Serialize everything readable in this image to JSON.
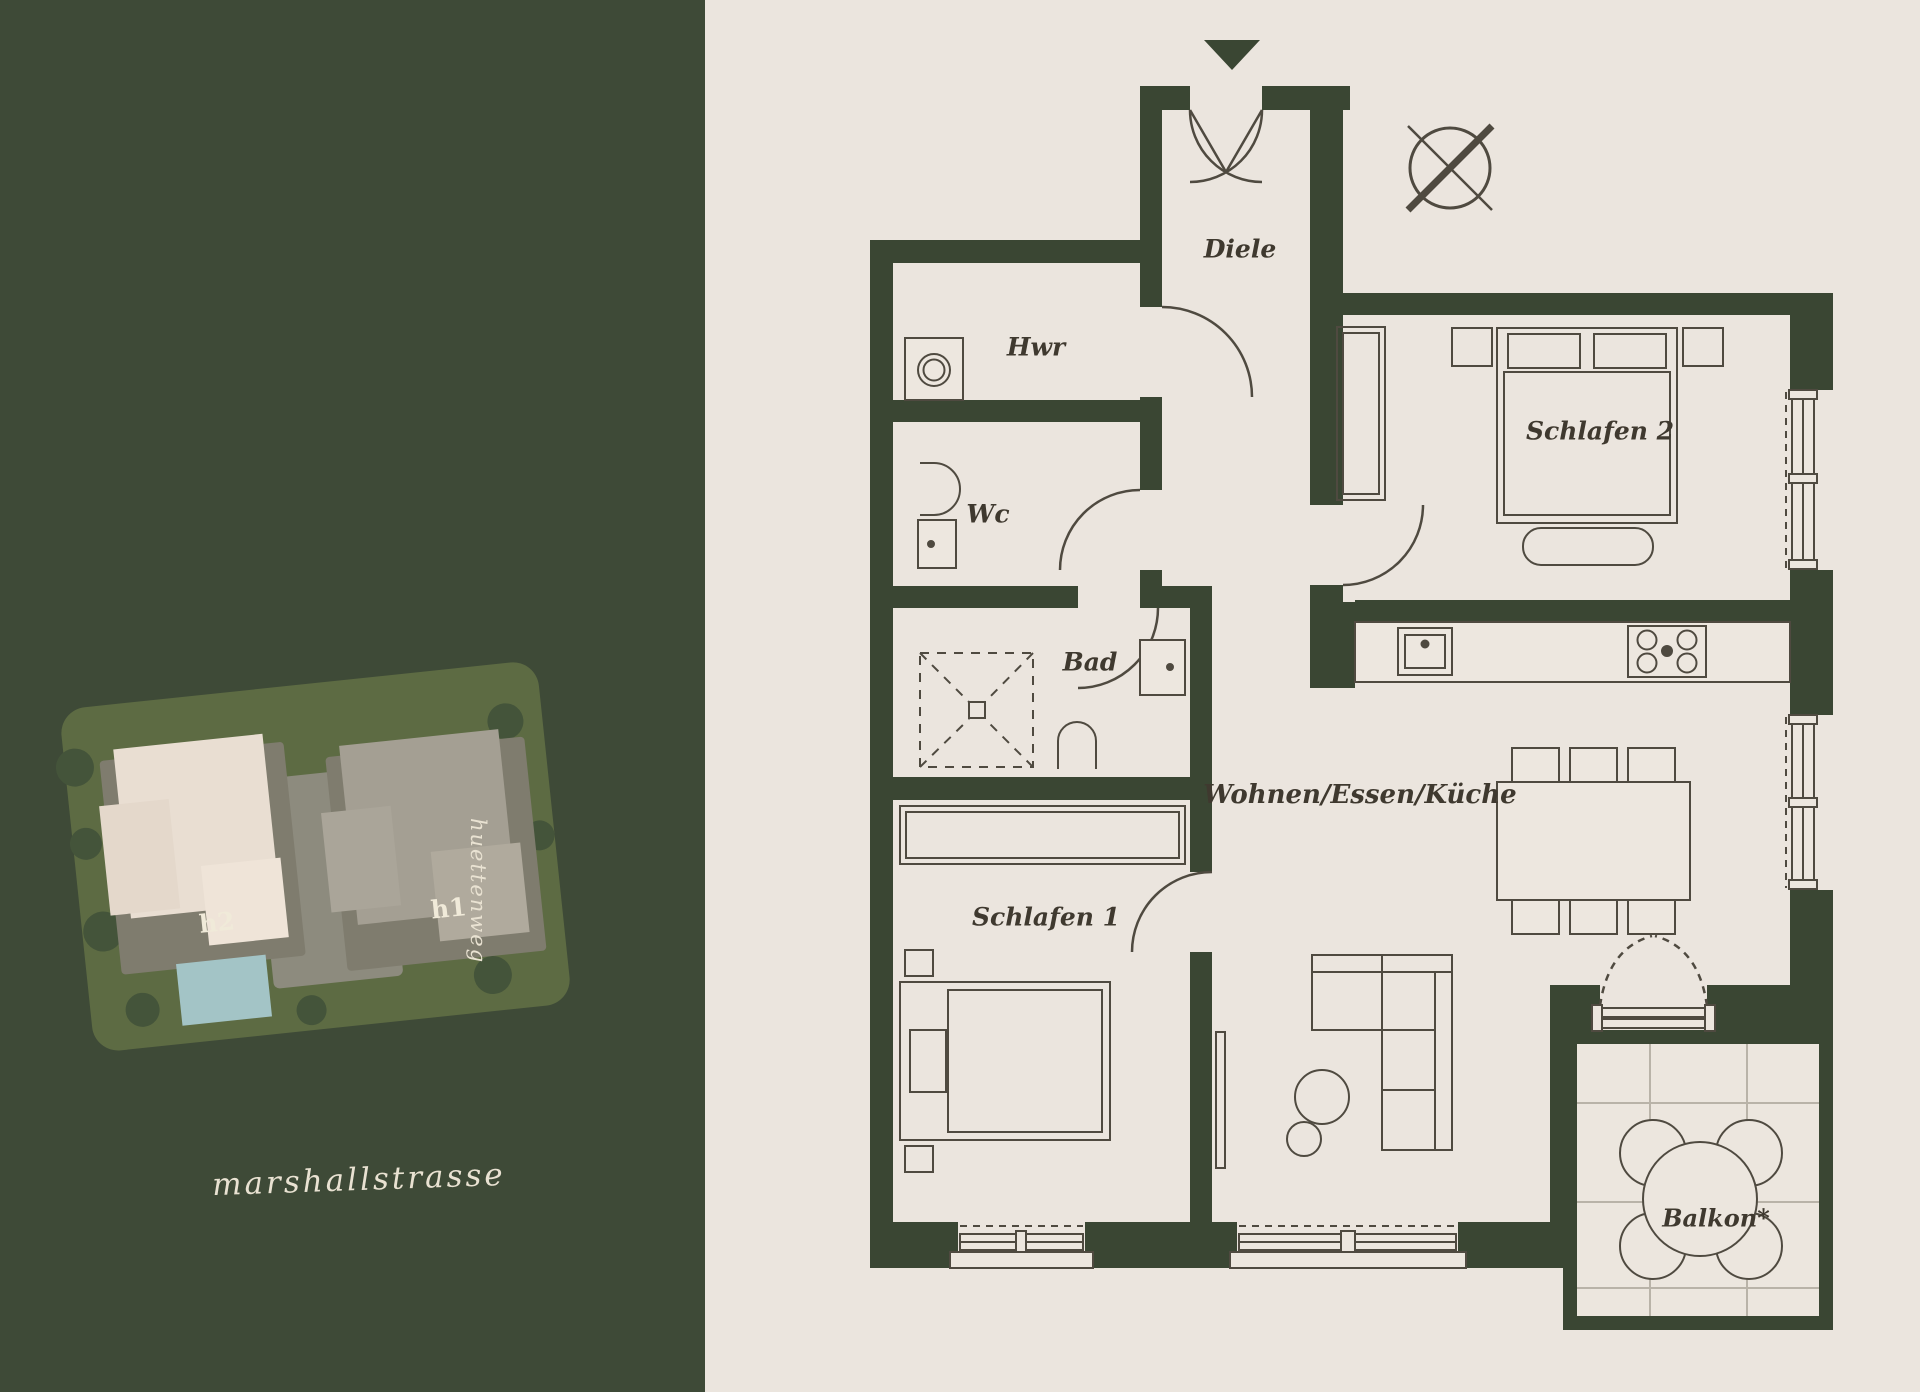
{
  "colors": {
    "panel_green": "#3e4a37",
    "page_cream": "#ebe5de",
    "wall_green": "#3a4633",
    "furniture_line": "#4f4a40",
    "floor_cream": "#ede7df",
    "tile_line": "#b9b3a8",
    "script_cream": "#e9e2d2",
    "site_ground_olive": "#5d6b43",
    "site_building_h2": "#e9ded2",
    "site_building_h1": "#a49f93",
    "site_pool_blue": "#a3c4c6"
  },
  "site_plan": {
    "building_labels": {
      "h2": "h2",
      "h1": "h1"
    },
    "street_horizontal": "marshallstrasse",
    "street_vertical": "huettenweg"
  },
  "floor_plan": {
    "rooms": {
      "diele": "Diele",
      "hwr": "Hwr",
      "wc": "Wc",
      "bad": "Bad",
      "schlafen1": "Schlafen 1",
      "schlafen2": "Schlafen 2",
      "wohnen": "Wohnen/Essen/Küche",
      "balkon": "Balkon*"
    },
    "icons": [
      "entrance-arrow-icon",
      "compass-icon",
      "washing-machine-icon",
      "toilet-icon",
      "sink-icon",
      "shower-icon",
      "kitchen-sink-icon",
      "stove-icon"
    ]
  }
}
